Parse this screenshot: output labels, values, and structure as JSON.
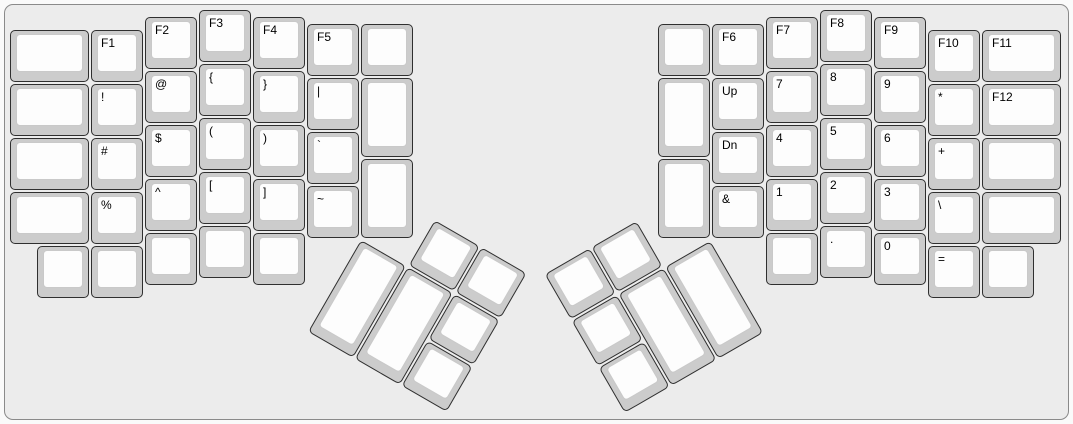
{
  "board": {
    "unit_px": 54,
    "page_background": "#fafafa",
    "case_background": "#ececec",
    "case_border_color": "#8a8a8a",
    "key_base_color": "#cccccc",
    "keytop_color": "#fdfdfd",
    "key_border_color": "#2f2f2f",
    "legend_color": "#000000"
  },
  "left_half": {
    "origin_x": 10,
    "origin_y": 10,
    "keys": [
      {
        "x": 0,
        "y": 0.375,
        "w": 1.5,
        "label": "",
        "name": "blank"
      },
      {
        "x": 0,
        "y": 1.375,
        "w": 1.5,
        "label": "",
        "name": "blank"
      },
      {
        "x": 0,
        "y": 2.375,
        "w": 1.5,
        "label": "",
        "name": "blank"
      },
      {
        "x": 0,
        "y": 3.375,
        "w": 1.5,
        "label": "",
        "name": "blank"
      },
      {
        "x": 1.5,
        "y": 0.375,
        "label": "F1",
        "name": "f1"
      },
      {
        "x": 1.5,
        "y": 1.375,
        "label": "!",
        "name": "exclamation"
      },
      {
        "x": 1.5,
        "y": 2.375,
        "label": "#",
        "name": "hash"
      },
      {
        "x": 1.5,
        "y": 3.375,
        "label": "%",
        "name": "percent"
      },
      {
        "x": 2.5,
        "y": 0.125,
        "label": "F2",
        "name": "f2"
      },
      {
        "x": 2.5,
        "y": 1.125,
        "label": "@",
        "name": "at"
      },
      {
        "x": 2.5,
        "y": 2.125,
        "label": "$",
        "name": "dollar"
      },
      {
        "x": 2.5,
        "y": 3.125,
        "label": "^",
        "name": "caret"
      },
      {
        "x": 2.5,
        "y": 4.125,
        "label": "",
        "name": "blank"
      },
      {
        "x": 3.5,
        "y": 0,
        "label": "F3",
        "name": "f3"
      },
      {
        "x": 3.5,
        "y": 1,
        "label": "{",
        "name": "brace-open"
      },
      {
        "x": 3.5,
        "y": 2,
        "label": "(",
        "name": "paren-open"
      },
      {
        "x": 3.5,
        "y": 3,
        "label": "[",
        "name": "bracket-open"
      },
      {
        "x": 3.5,
        "y": 4,
        "label": "",
        "name": "blank"
      },
      {
        "x": 4.5,
        "y": 0.125,
        "label": "F4",
        "name": "f4"
      },
      {
        "x": 4.5,
        "y": 1.125,
        "label": "}",
        "name": "brace-close"
      },
      {
        "x": 4.5,
        "y": 2.125,
        "label": ")",
        "name": "paren-close"
      },
      {
        "x": 4.5,
        "y": 3.125,
        "label": "]",
        "name": "bracket-close"
      },
      {
        "x": 4.5,
        "y": 4.125,
        "label": "",
        "name": "blank"
      },
      {
        "x": 5.5,
        "y": 0.25,
        "label": "F5",
        "name": "f5"
      },
      {
        "x": 5.5,
        "y": 1.25,
        "label": "|",
        "name": "pipe"
      },
      {
        "x": 5.5,
        "y": 2.25,
        "label": "`",
        "name": "backtick"
      },
      {
        "x": 5.5,
        "y": 3.25,
        "label": "~",
        "name": "tilde"
      },
      {
        "x": 6.5,
        "y": 0.25,
        "label": "",
        "name": "blank"
      },
      {
        "x": 6.5,
        "y": 1.25,
        "h": 1.5,
        "label": "",
        "name": "blank"
      },
      {
        "x": 6.5,
        "y": 2.75,
        "h": 1.5,
        "label": "",
        "name": "blank"
      },
      {
        "x": 0.5,
        "y": 4.375,
        "label": "",
        "name": "blank"
      },
      {
        "x": 1.5,
        "y": 4.375,
        "label": "",
        "name": "blank"
      }
    ]
  },
  "right_half": {
    "origin_x": 658,
    "origin_y": 10,
    "keys": [
      {
        "x": 0,
        "y": 0.25,
        "label": "",
        "name": "blank"
      },
      {
        "x": 0,
        "y": 1.25,
        "h": 1.5,
        "label": "",
        "name": "blank"
      },
      {
        "x": 0,
        "y": 2.75,
        "h": 1.5,
        "label": "",
        "name": "blank"
      },
      {
        "x": 1,
        "y": 0.25,
        "label": "F6",
        "name": "f6"
      },
      {
        "x": 1,
        "y": 1.25,
        "label": "Up",
        "name": "up"
      },
      {
        "x": 1,
        "y": 2.25,
        "label": "Dn",
        "name": "down"
      },
      {
        "x": 1,
        "y": 3.25,
        "label": "&",
        "name": "ampersand"
      },
      {
        "x": 2,
        "y": 0.125,
        "label": "F7",
        "name": "f7"
      },
      {
        "x": 2,
        "y": 1.125,
        "label": "7",
        "name": "digit-7"
      },
      {
        "x": 2,
        "y": 2.125,
        "label": "4",
        "name": "digit-4"
      },
      {
        "x": 2,
        "y": 3.125,
        "label": "1",
        "name": "digit-1"
      },
      {
        "x": 2,
        "y": 4.125,
        "label": "",
        "name": "blank"
      },
      {
        "x": 3,
        "y": 0,
        "label": "F8",
        "name": "f8"
      },
      {
        "x": 3,
        "y": 1,
        "label": "8",
        "name": "digit-8"
      },
      {
        "x": 3,
        "y": 2,
        "label": "5",
        "name": "digit-5"
      },
      {
        "x": 3,
        "y": 3,
        "label": "2",
        "name": "digit-2"
      },
      {
        "x": 3,
        "y": 4,
        "label": ".",
        "name": "period"
      },
      {
        "x": 4,
        "y": 0.125,
        "label": "F9",
        "name": "f9"
      },
      {
        "x": 4,
        "y": 1.125,
        "label": "9",
        "name": "digit-9"
      },
      {
        "x": 4,
        "y": 2.125,
        "label": "6",
        "name": "digit-6"
      },
      {
        "x": 4,
        "y": 3.125,
        "label": "3",
        "name": "digit-3"
      },
      {
        "x": 4,
        "y": 4.125,
        "label": "0",
        "name": "digit-0"
      },
      {
        "x": 5,
        "y": 0.375,
        "label": "F10",
        "name": "f10"
      },
      {
        "x": 5,
        "y": 1.375,
        "label": "*",
        "name": "asterisk"
      },
      {
        "x": 5,
        "y": 2.375,
        "label": "+",
        "name": "plus"
      },
      {
        "x": 5,
        "y": 3.375,
        "label": "\\",
        "name": "backslash"
      },
      {
        "x": 5,
        "y": 4.375,
        "label": "=",
        "name": "equals"
      },
      {
        "x": 6,
        "y": 0.375,
        "w": 1.5,
        "label": "F11",
        "name": "f11"
      },
      {
        "x": 6,
        "y": 1.375,
        "w": 1.5,
        "label": "F12",
        "name": "f12"
      },
      {
        "x": 6,
        "y": 2.375,
        "w": 1.5,
        "label": "",
        "name": "blank"
      },
      {
        "x": 6,
        "y": 3.375,
        "w": 1.5,
        "label": "",
        "name": "blank"
      },
      {
        "x": 6,
        "y": 4.375,
        "label": "",
        "name": "blank"
      }
    ]
  },
  "left_thumb_cluster": {
    "rotation_deg": 30,
    "center_x": 361,
    "center_y": 239.5,
    "keys": [
      {
        "x": 1,
        "y": -1,
        "label": "",
        "name": "blank"
      },
      {
        "x": 2,
        "y": -1,
        "label": "",
        "name": "blank"
      },
      {
        "x": 0,
        "y": 0,
        "h": 2,
        "label": "",
        "name": "blank"
      },
      {
        "x": 1,
        "y": 0,
        "h": 2,
        "label": "",
        "name": "blank"
      },
      {
        "x": 2,
        "y": 0,
        "label": "",
        "name": "blank"
      },
      {
        "x": 2,
        "y": 1,
        "label": "",
        "name": "blank"
      }
    ]
  },
  "right_thumb_cluster": {
    "rotation_deg": -30,
    "center_x": 712,
    "center_y": 239.5,
    "keys": [
      {
        "x": -3,
        "y": -1,
        "label": "",
        "name": "blank"
      },
      {
        "x": -2,
        "y": -1,
        "label": "",
        "name": "blank"
      },
      {
        "x": -3,
        "y": 0,
        "label": "",
        "name": "blank"
      },
      {
        "x": -2,
        "y": 0,
        "h": 2,
        "label": "",
        "name": "blank"
      },
      {
        "x": -1,
        "y": 0,
        "h": 2,
        "label": "",
        "name": "blank"
      },
      {
        "x": -3,
        "y": 1,
        "label": "",
        "name": "blank"
      }
    ]
  }
}
